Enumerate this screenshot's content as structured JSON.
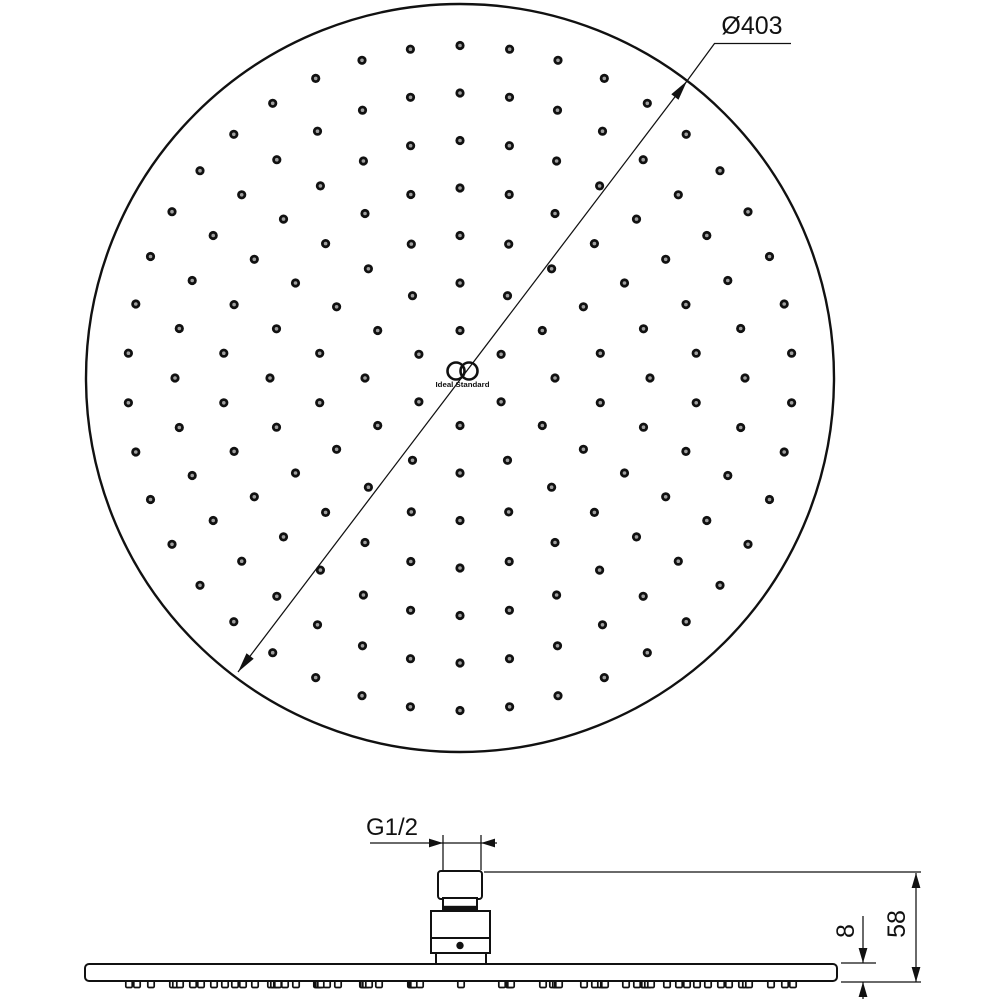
{
  "drawing": {
    "top_view": {
      "diameter_label": "Ø403",
      "logo_text": "Ideal Standard"
    },
    "side_view": {
      "thread_label": "G1/2",
      "overall_height_label": "58",
      "plate_thickness_label": "8"
    },
    "colors": {
      "line": "#111111",
      "background": "#ffffff",
      "dot_center": "#a0a0a0"
    },
    "nozzle_pattern": {
      "rings": 7,
      "ring_spacing_px": 47.5,
      "dots_per_ring_multiple": 6,
      "start_angle_deg": 90,
      "center": {
        "x": 460,
        "y": 378
      },
      "face_radius_px": 374,
      "dot_outer_radius_px": 4.6,
      "dot_inner_radius_px": 1.8
    },
    "side_plate": {
      "left_x": 85,
      "width": 752,
      "top_y": 964,
      "height": 17,
      "nub_width": 6.4,
      "nub_height": 7,
      "nub_top_y": 980.5
    }
  }
}
